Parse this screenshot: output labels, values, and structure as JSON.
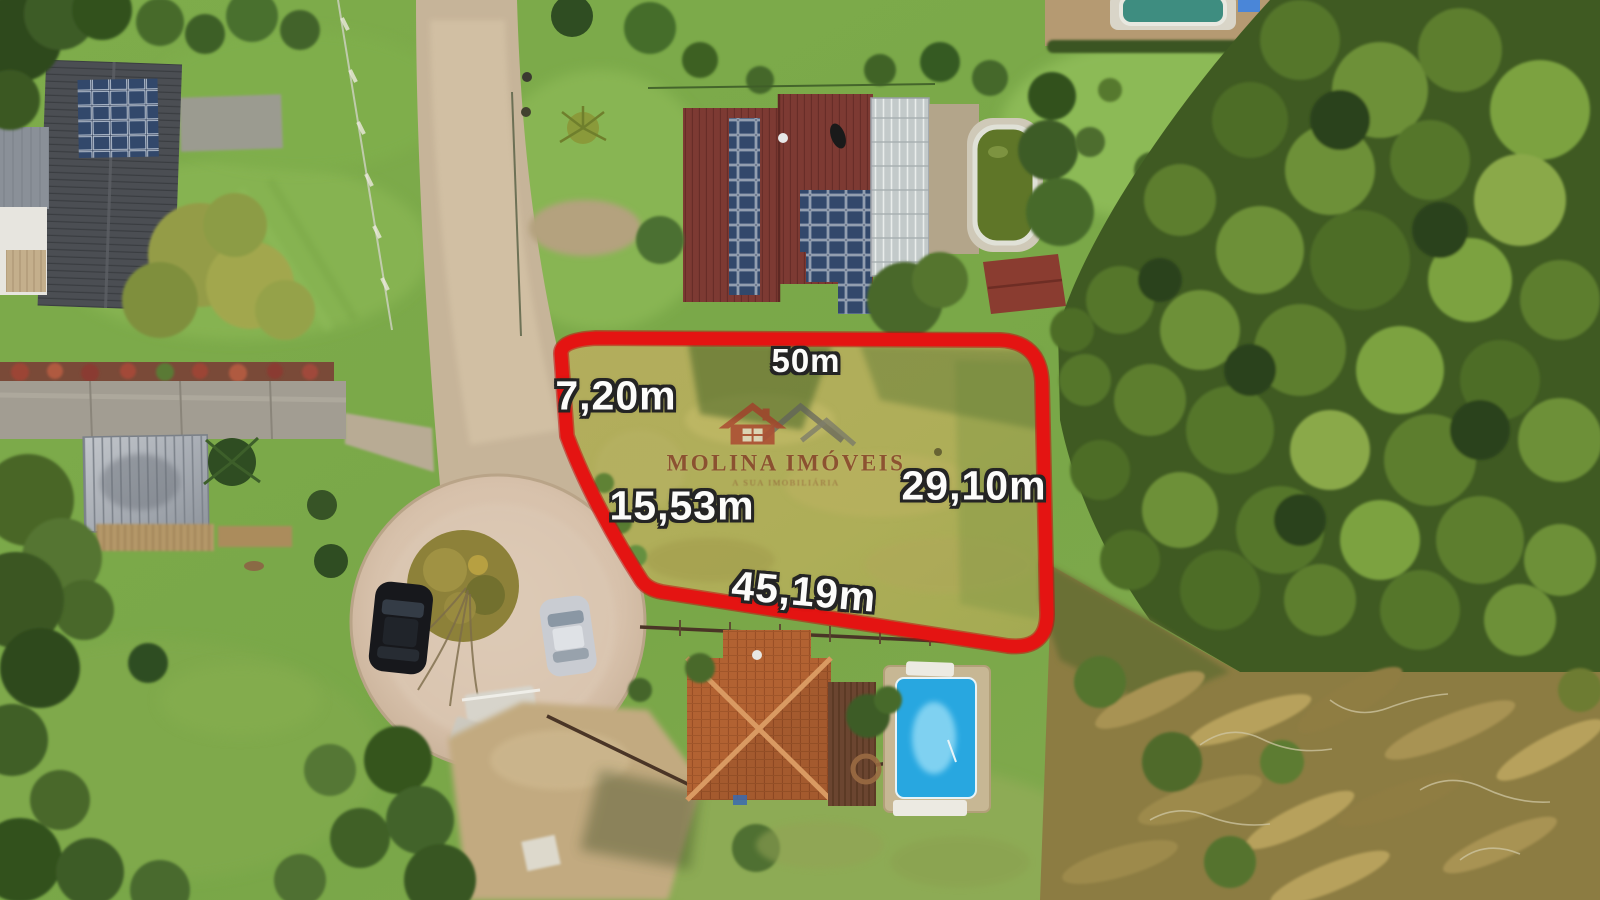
{
  "image": {
    "type": "aerial-drone-photograph",
    "subject": "residential land lot for sale outlined in red, neighborhood with houses, pools, cul-de-sac and forest"
  },
  "lot": {
    "boundary_color": "#e41412",
    "dimensions": {
      "top": "50m",
      "left_upper": "7,20m",
      "left_lower": "15,53m",
      "right": "29,10m",
      "bottom": "45,19m"
    }
  },
  "watermark": {
    "brand": "MOLINA IMÓVEIS",
    "tagline": "A SUA IMOBILIÁRIA",
    "house_color": "#a83327",
    "roofline_color": "#5e5e5e",
    "text_color": "#79241c"
  },
  "scene": {
    "objects": [
      "dirt-road",
      "cul-de-sac",
      "island-with-bare-tree",
      "black-car",
      "silver-car",
      "parked-silver-car",
      "house-with-solar-panels-top-left",
      "metal-shed",
      "house-with-solar-panels-and-greenhouse",
      "green-pool",
      "top-pool",
      "blue-pool",
      "orange-hip-roof-house",
      "wood-fences",
      "forest-right",
      "dry-scrub-bottom-right",
      "grass-lot-field"
    ]
  }
}
